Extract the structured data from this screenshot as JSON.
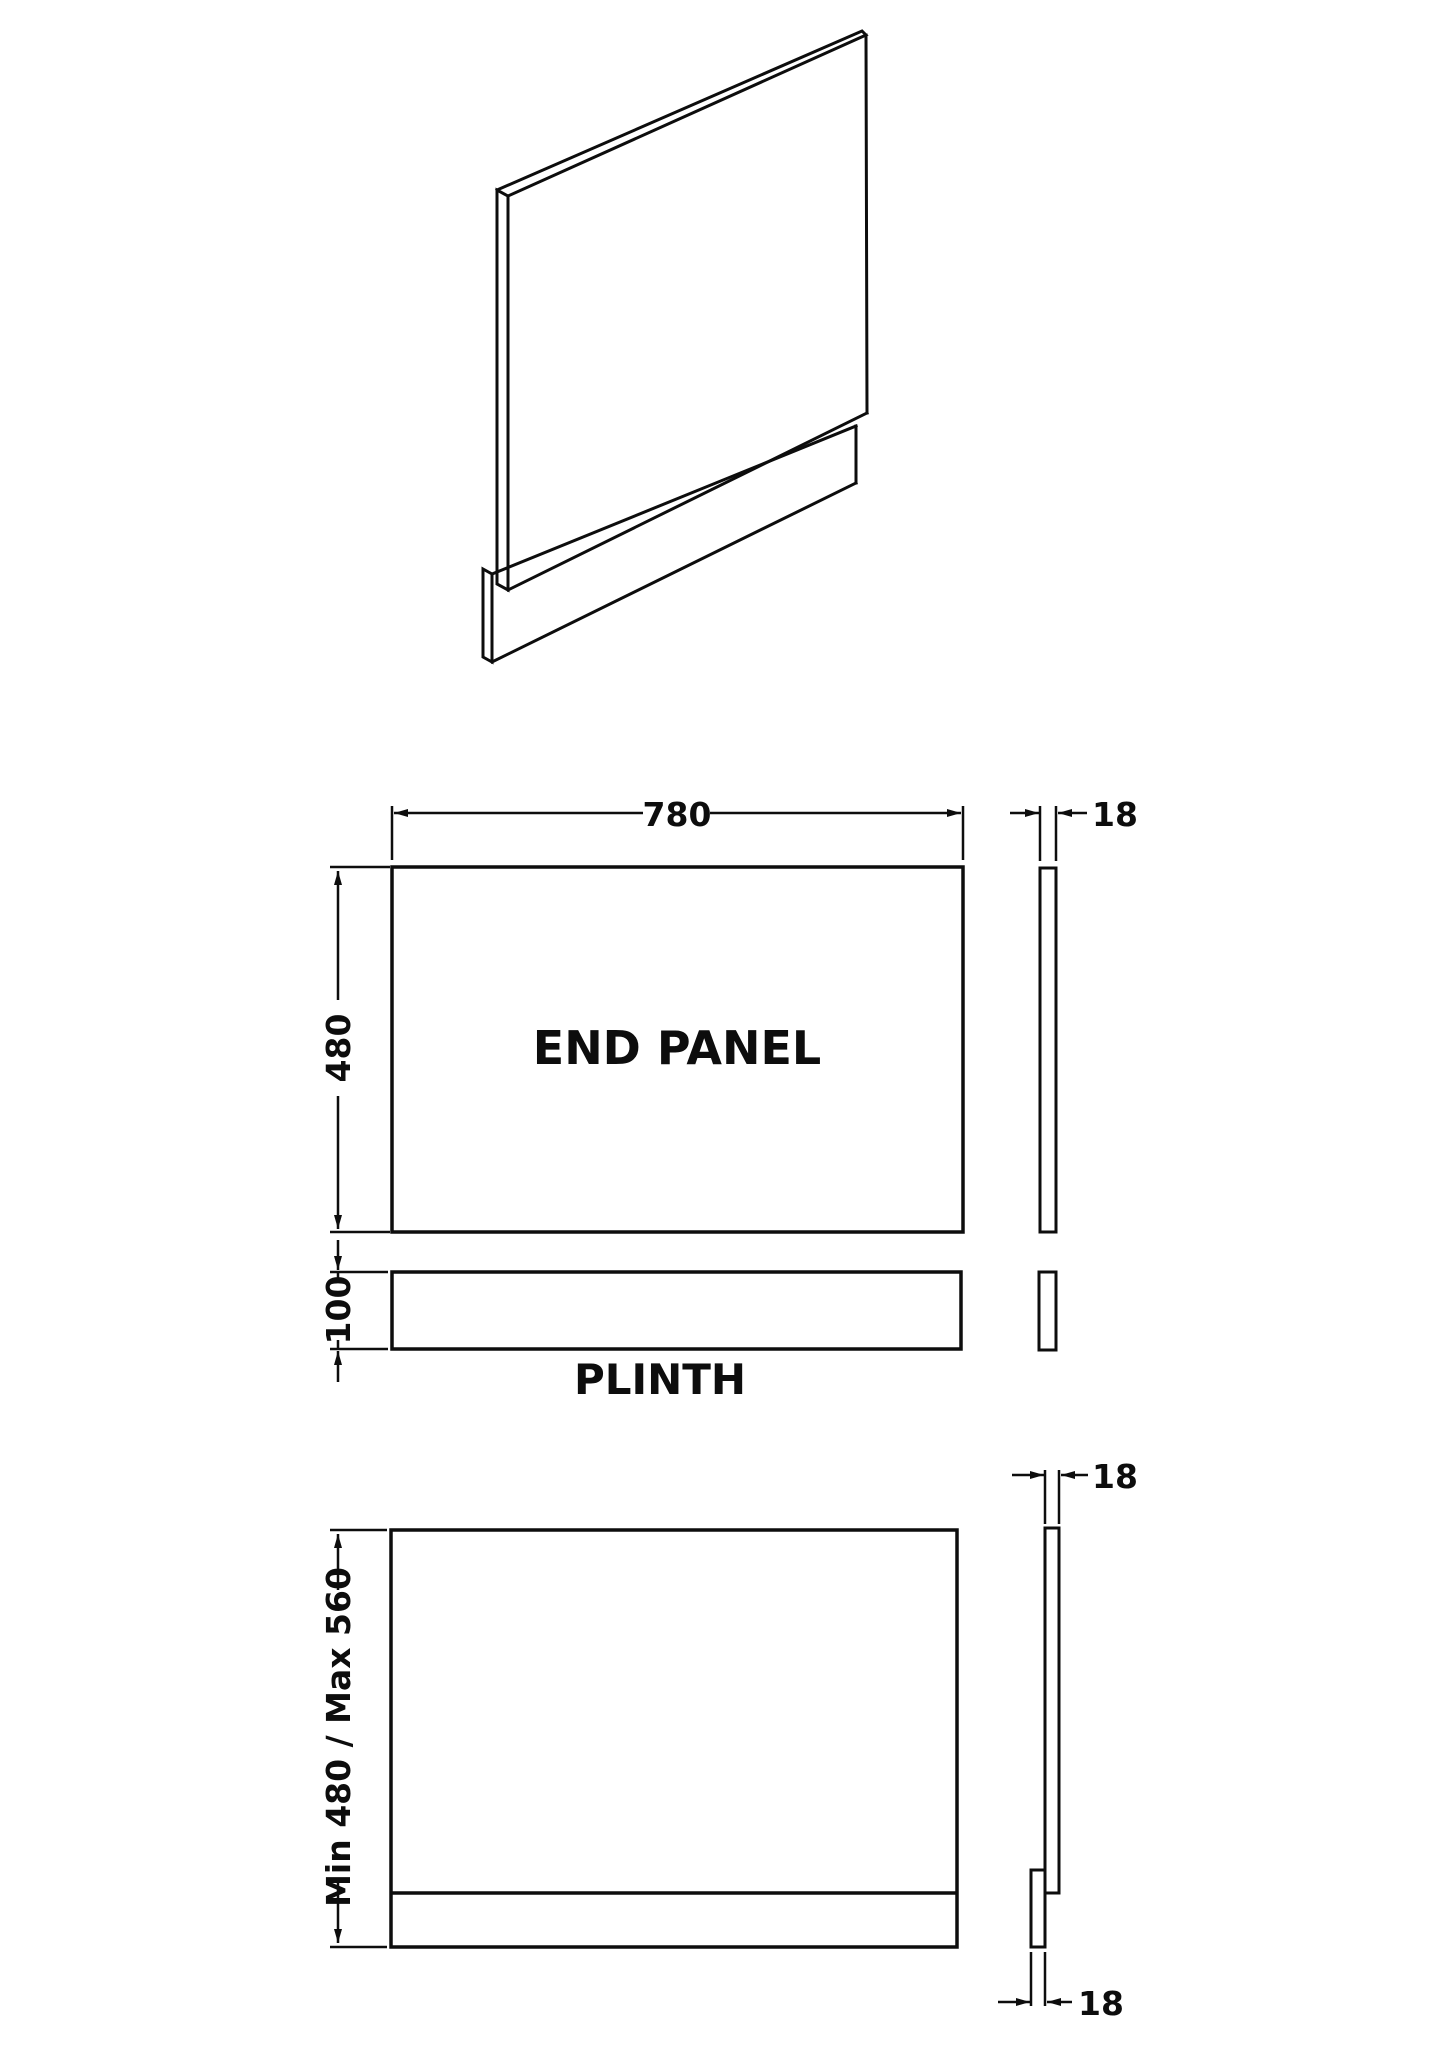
{
  "drawing": {
    "front_view": {
      "panel_label": "END PANEL",
      "width_dim": "780",
      "height_dim": "480",
      "thickness_dim": "18"
    },
    "plinth_view": {
      "label": "PLINTH",
      "height_dim": "100"
    },
    "installation_view": {
      "height_range_dim": "Min 480 / Max 560",
      "panel_thickness_dim": "18",
      "plinth_thickness_dim": "18"
    },
    "colors": {
      "line": "#0d0d0d",
      "background": "#ffffff"
    }
  }
}
